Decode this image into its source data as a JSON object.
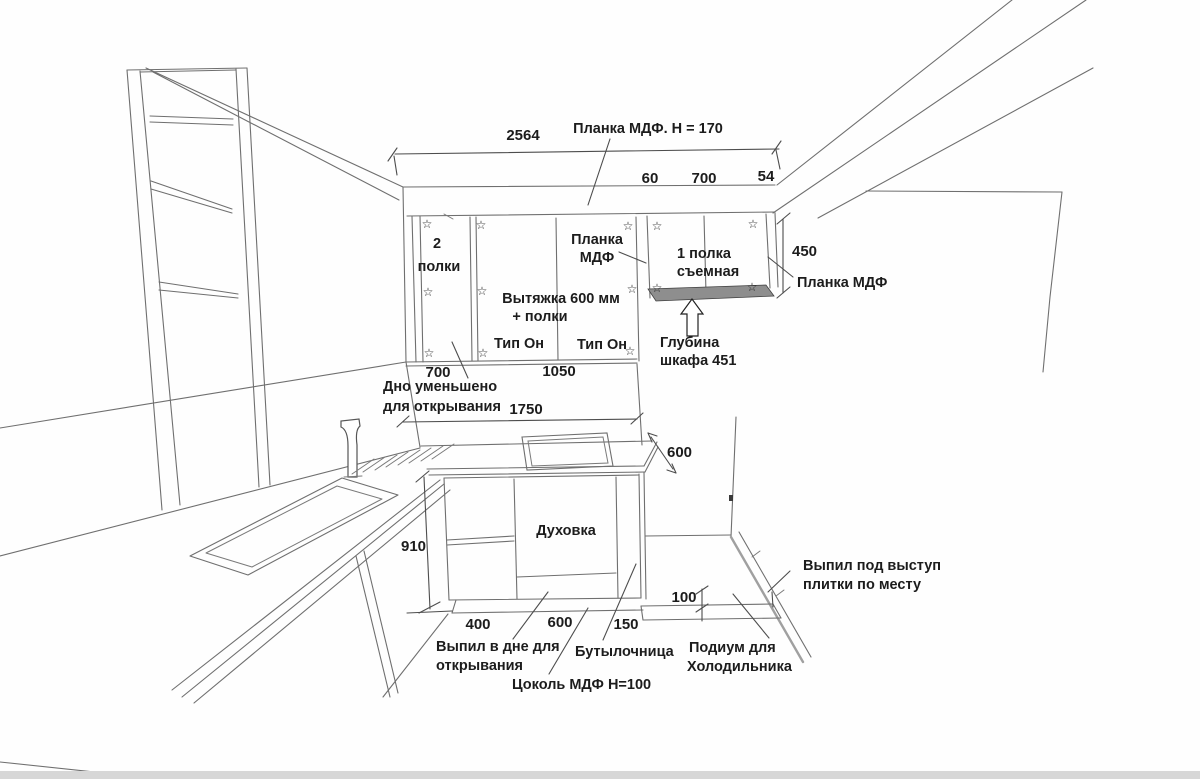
{
  "annotations": {
    "top_batten": "Планка МДФ. Н = 170",
    "total_width": "2564",
    "filler_width": "60",
    "right_cab_width_top": "700",
    "edge_gap": "54",
    "left_cab": [
      "2",
      "полки"
    ],
    "center_batten": [
      "Планка",
      "МДФ"
    ],
    "right_cab": [
      "1 полка",
      "съемная"
    ],
    "hood": [
      "Вытяжка 600 мм",
      "+ полки"
    ],
    "door_type_left": "Тип Он",
    "door_type_right": "Тип Он",
    "right_batten_height": "450",
    "right_batten": "Планка МДФ",
    "cab_depth": [
      "Глубина",
      "шкафа 451"
    ],
    "left_cab_width": "700",
    "hood_width": "1050",
    "bottom_reduced": [
      "Дно уменьшено",
      "для открывания"
    ],
    "wall_width": "1750",
    "counter_depth": "600",
    "counter_height": "910",
    "oven": "Духовка",
    "base_seg_1": "400",
    "base_seg_2": "600",
    "base_seg_3": "150",
    "podium_height": "100",
    "bottom_cutout": [
      "Выпил в дне для",
      "открывания"
    ],
    "bottle_rack": "Бутылочница",
    "plinth": "Цоколь МДФ Н=100",
    "podium": [
      "Подиум для",
      "Холодильника"
    ],
    "tile_cutout": [
      "Выпил под выступ",
      "плитки по месту"
    ]
  },
  "icons": {
    "star": "☆"
  },
  "colors": {
    "paper": "#fefefe",
    "ink": "#1c1c1c",
    "line": "#6f6f6f",
    "shade": "#8e8e8e"
  }
}
